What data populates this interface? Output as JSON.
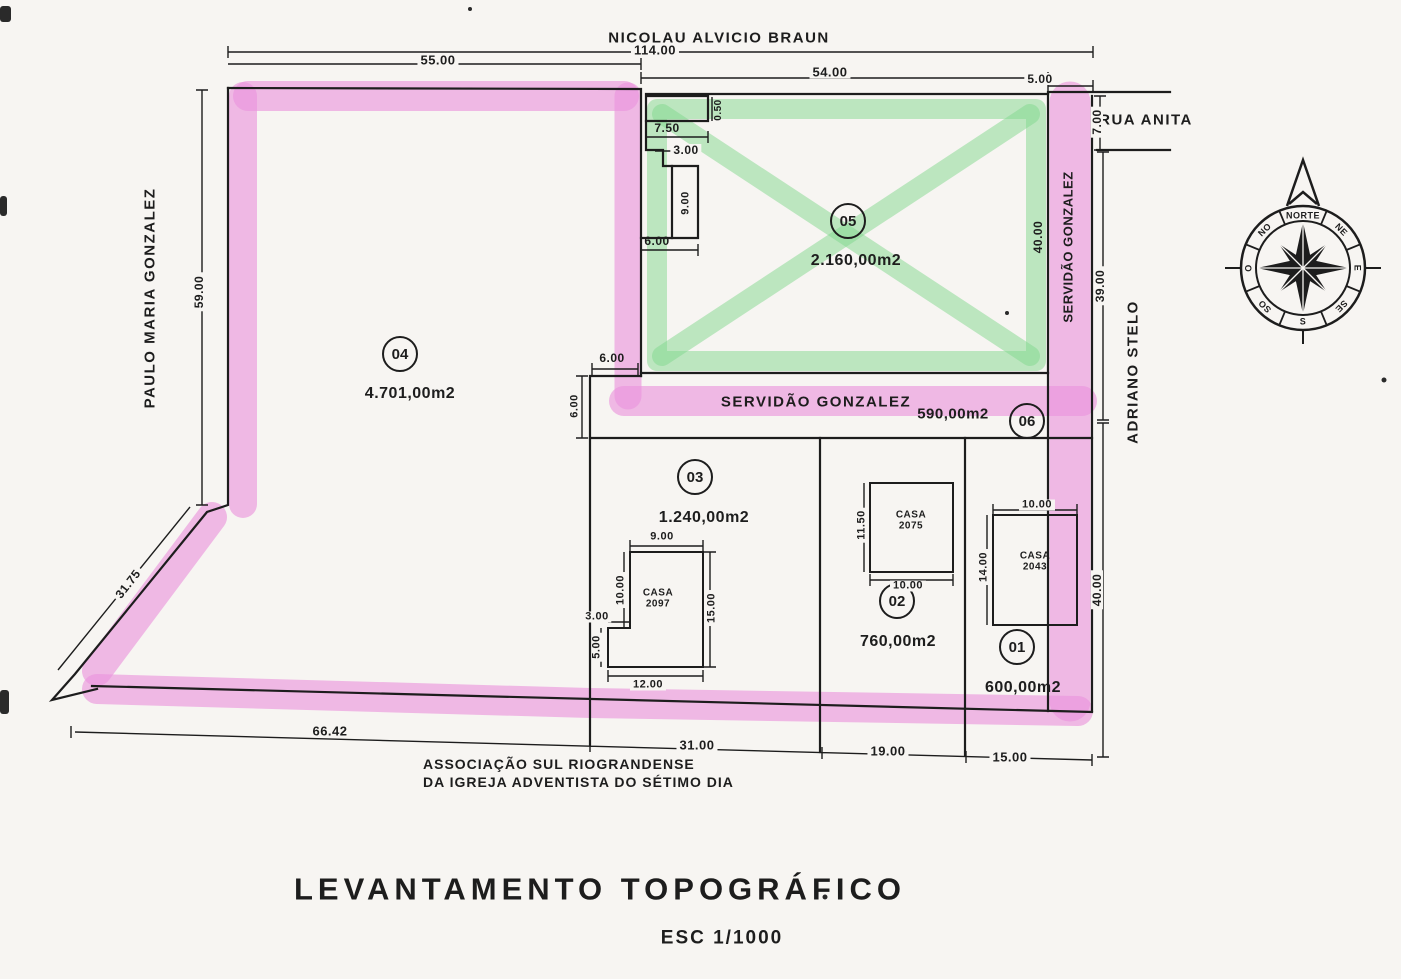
{
  "title": {
    "main": "LEVANTAMENTO TOPOGRÁFICO",
    "scale": "ESC 1/1000"
  },
  "streets": {
    "top": "NICOLAU ALVICIO BRAUN",
    "left": "PAULO MARIA GONZALEZ",
    "rua_anita": "RUA ANITA",
    "right": "ADRIANO STELO",
    "servidao_vertical": "SERVIDÃO GONZALEZ",
    "servidao_horizontal": "SERVIDÃO GONZALEZ",
    "assoc_line1": "ASSOCIAÇÃO SUL RIOGRANDENSE",
    "assoc_line2": "DA IGREJA ADVENTISTA DO SÉTIMO DIA"
  },
  "lots": {
    "lot01": {
      "num": "01",
      "area": "600,00m2"
    },
    "lot02": {
      "num": "02",
      "area": "760,00m2"
    },
    "lot03": {
      "num": "03",
      "area": "1.240,00m2"
    },
    "lot04": {
      "num": "04",
      "area": "4.701,00m2"
    },
    "lot05": {
      "num": "05",
      "area": "2.160,00m2"
    },
    "lot06": {
      "num": "06",
      "area": "590,00m2"
    }
  },
  "houses": {
    "h2097": {
      "l1": "CASA",
      "l2": "2097"
    },
    "h2075": {
      "l1": "CASA",
      "l2": "2075"
    },
    "h2043": {
      "l1": "CASA",
      "l2": "2043"
    }
  },
  "dims": {
    "top_total": "114.00",
    "top_a": "55.00",
    "top_b": "54.00",
    "top_c": "5.00",
    "rua_w": "7.00",
    "right_a": "39.00",
    "right_b": "40.00",
    "lot05_e": "40.00",
    "left_a": "59.00",
    "diag": "31.75",
    "bot_a": "66.42",
    "bot_b": "31.00",
    "bot_c": "19.00",
    "bot_d": "15.00",
    "n050": "0.50",
    "n750": "7.50",
    "n300": "3.00",
    "n900": "9.00",
    "n600": "6.00",
    "sv_a": "6.00",
    "sv_b": "6.00",
    "c97_top": "9.00",
    "c97_l": "10.00",
    "c97_s": "3.00",
    "c97_l2": "5.00",
    "c97_b": "12.00",
    "c97_r": "15.00",
    "c75_l": "11.50",
    "c75_b": "10.00",
    "c43_t": "10.00",
    "c43_l": "14.00"
  },
  "compass": {
    "norte": "NORTE",
    "no": "NO",
    "ne": "NE",
    "e": "E",
    "se": "SE",
    "s": "S",
    "so": "SO",
    "o": "O"
  },
  "colors": {
    "highlighter_pink": "#f29ae9",
    "highlighter_green": "#86e295",
    "ink": "#1d1d1d",
    "paper": "#f7f5f2"
  }
}
